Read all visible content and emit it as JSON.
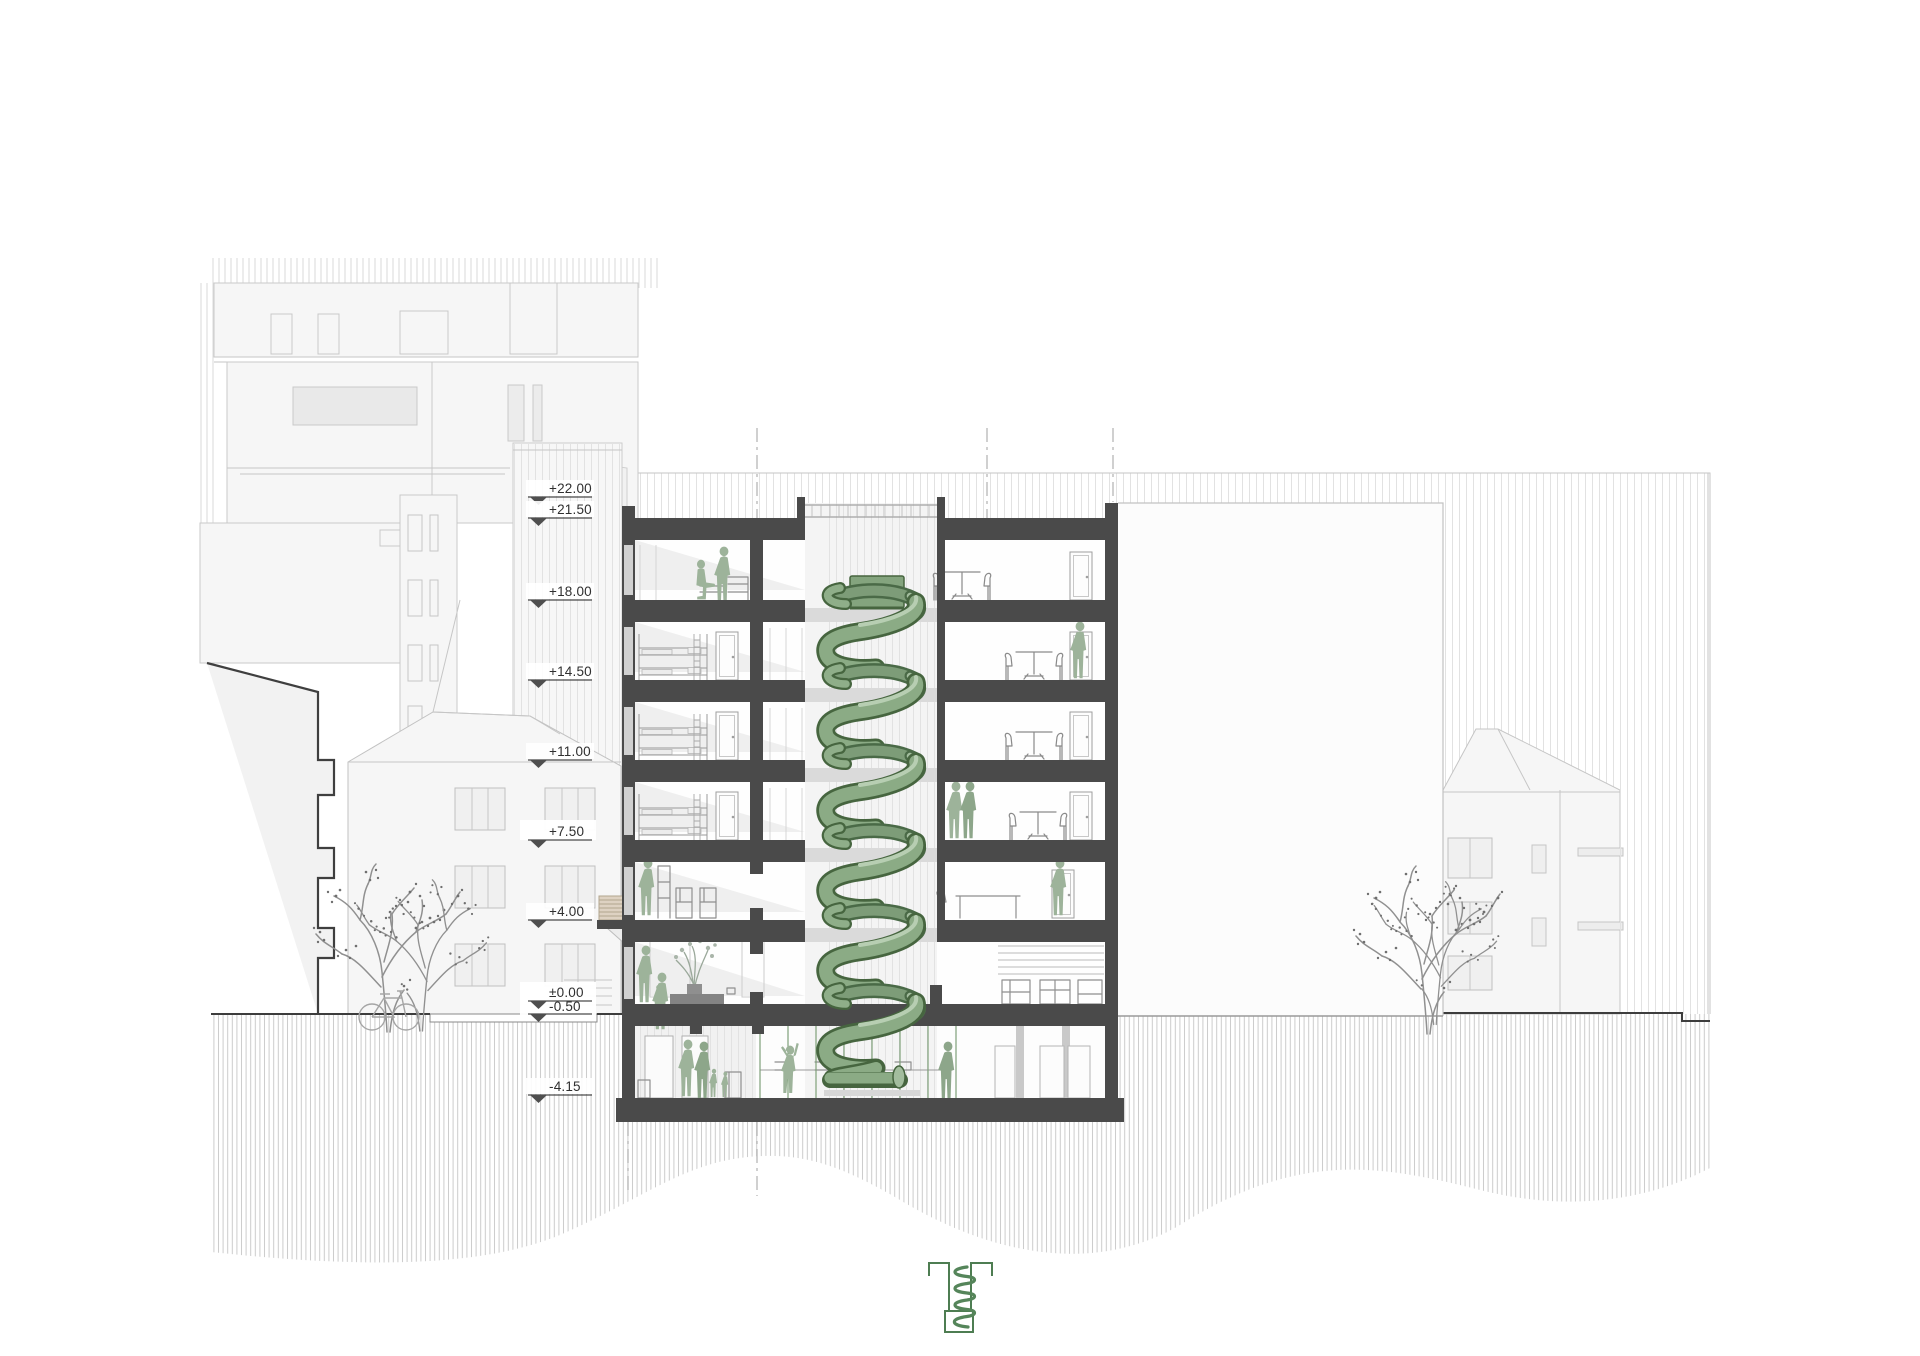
{
  "drawing": {
    "type": "architectural cross-section",
    "description": "Building section with spiral slide in atrium, neighbouring buildings, trees and level datum markers"
  },
  "levels": [
    {
      "label": "+22.00"
    },
    {
      "label": "+21.50"
    },
    {
      "label": "+18.00"
    },
    {
      "label": "+14.50"
    },
    {
      "label": "+11.00"
    },
    {
      "label": "+7.50"
    },
    {
      "label": "+4.00"
    },
    {
      "label": "±0.00"
    },
    {
      "label": "-0.50"
    },
    {
      "label": "-4.15"
    }
  ],
  "colors": {
    "slide_green": "#8bab85",
    "slide_green_dark": "#46653f",
    "slide_green_light": "#b7ceb2",
    "people_green": "#9db39a",
    "section_cut_gray": "#4a4a4a",
    "logo_green": "#4e7d52",
    "background_line": "#c9c9c9"
  },
  "icons": {
    "logo": "spiral-slide-section-logo",
    "slide": "helical-slide",
    "datum": "level-datum-triangle"
  }
}
